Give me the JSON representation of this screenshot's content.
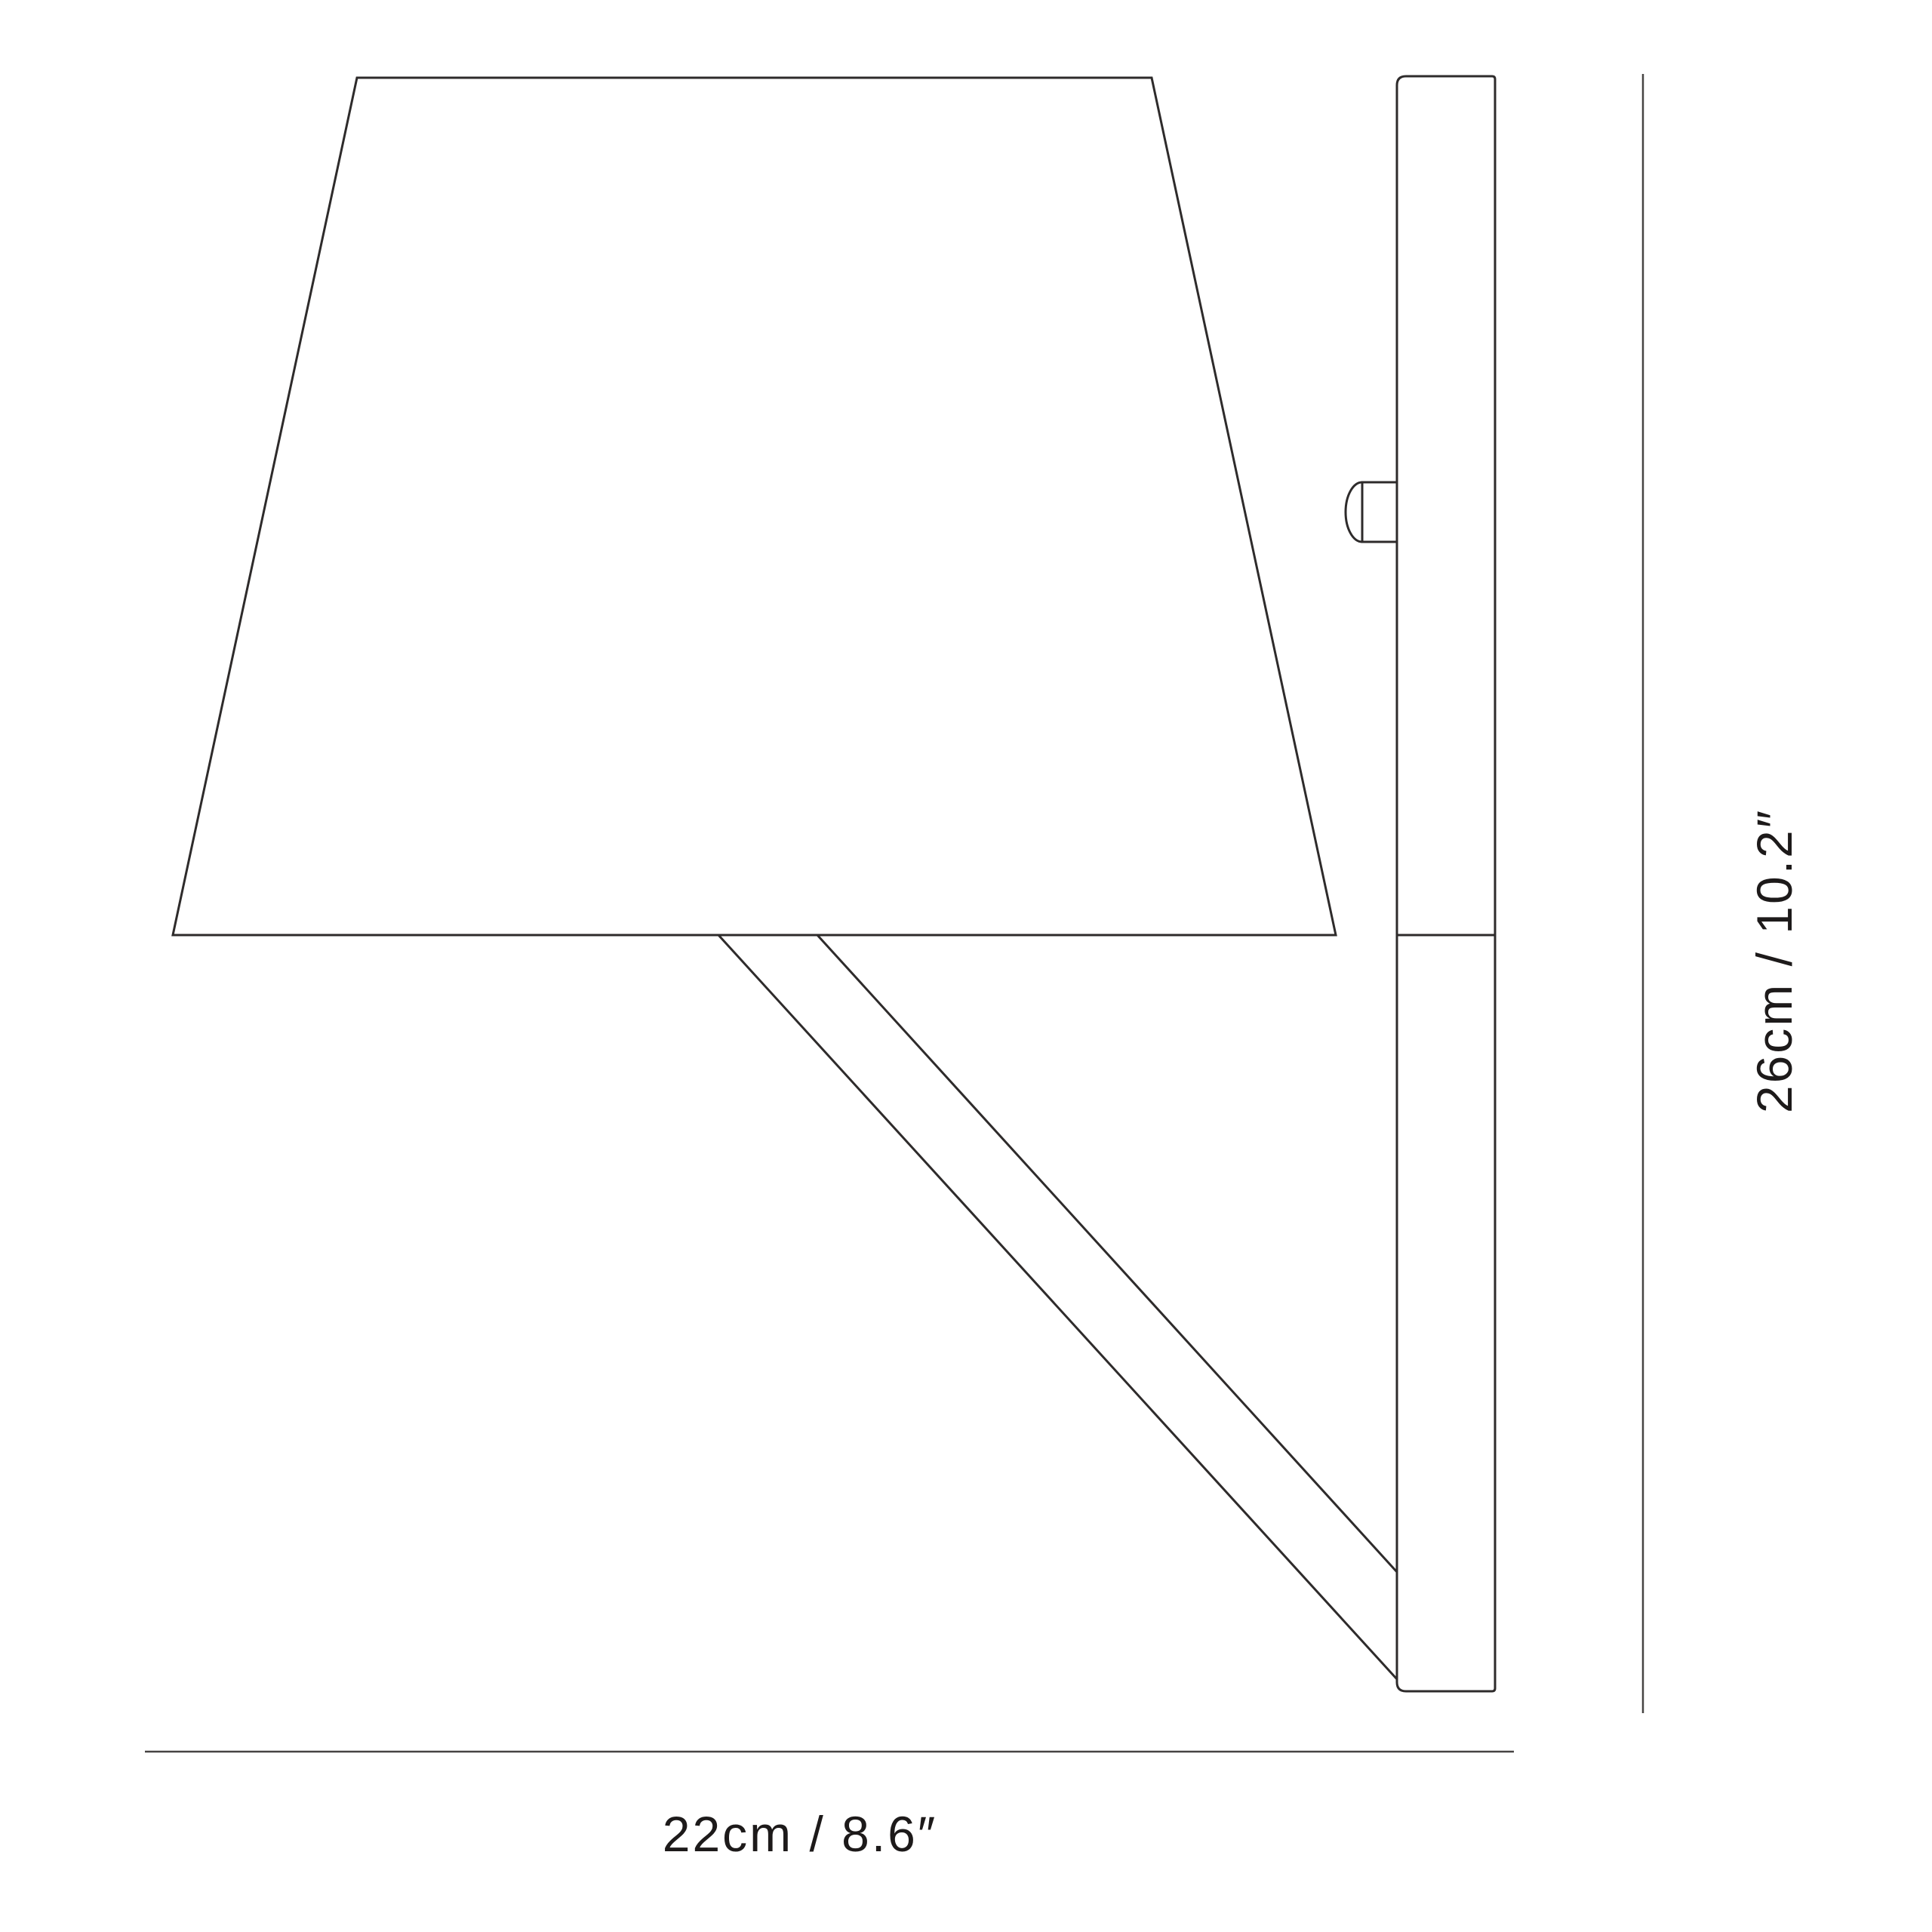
{
  "canvas": {
    "background": "#ffffff",
    "line_color": "#2e2b2b",
    "dimension_line_color": "#474443",
    "text_color": "#1d1a1a"
  },
  "labels": {
    "width_dimension": "22cm / 8.6″",
    "height_dimension": "26cm / 10.2″"
  },
  "dimensions": {
    "width": {
      "cm": 22,
      "inches": 8.6
    },
    "height": {
      "cm": 26,
      "inches": 10.2
    }
  }
}
